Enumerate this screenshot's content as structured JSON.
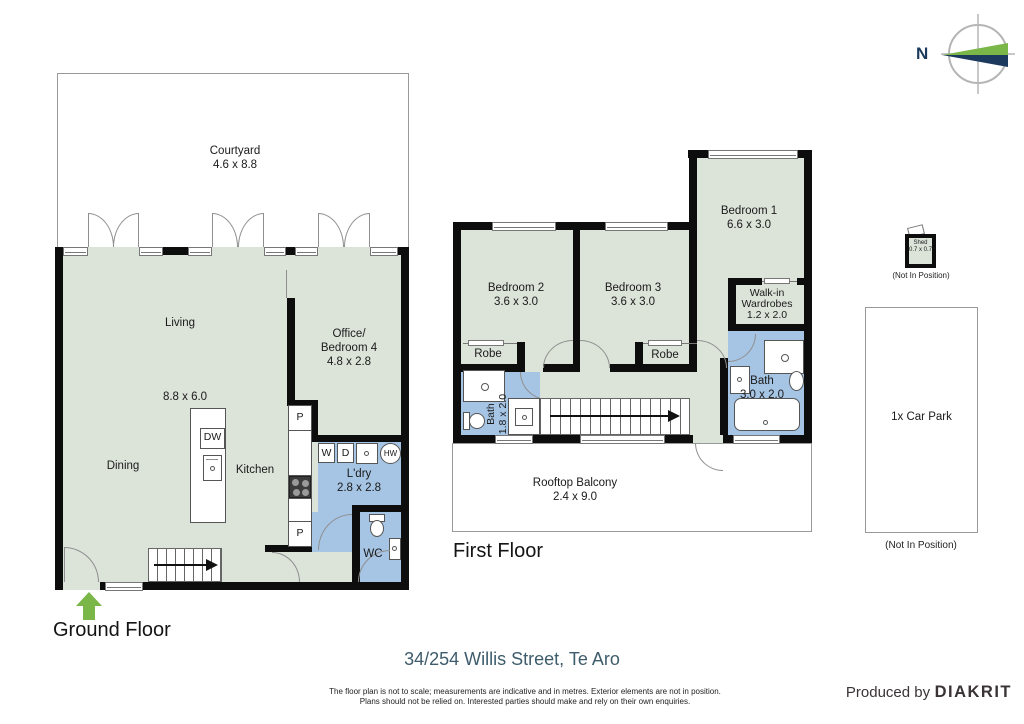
{
  "compass": {
    "north_label": "N"
  },
  "ground_floor": {
    "title": "Ground Floor",
    "courtyard": {
      "name": "Courtyard",
      "dims": "4.6 x 8.8"
    },
    "living": {
      "name": "Living",
      "dims": "8.8 x 6.0"
    },
    "office": {
      "line1": "Office/",
      "line2": "Bedroom 4",
      "dims": "4.8 x 2.8"
    },
    "dining": {
      "name": "Dining"
    },
    "kitchen": {
      "name": "Kitchen",
      "dishwasher": "DW",
      "pantry_top": "P",
      "pantry_bottom": "P"
    },
    "laundry": {
      "name": "L'dry",
      "dims": "2.8 x 2.8",
      "washer": "W",
      "dryer": "D",
      "hot_water": "HW"
    },
    "wc": {
      "name": "WC"
    }
  },
  "first_floor": {
    "title": "First Floor",
    "bedroom1": {
      "name": "Bedroom 1",
      "dims": "6.6 x 3.0"
    },
    "bedroom2": {
      "name": "Bedroom 2",
      "dims": "3.6 x 3.0"
    },
    "bedroom3": {
      "name": "Bedroom 3",
      "dims": "3.6 x 3.0"
    },
    "walkin": {
      "line1": "Walk-in",
      "line2": "Wardrobes",
      "dims": "1.2 x 2.0"
    },
    "robe_left": {
      "name": "Robe"
    },
    "robe_right": {
      "name": "Robe"
    },
    "bath_small": {
      "name": "Bath",
      "dims": "1.8 x 2.0"
    },
    "bath_main": {
      "name": "Bath",
      "dims": "3.0 x 2.0"
    },
    "balcony": {
      "name": "Rooftop Balcony",
      "dims": "2.4 x 9.0"
    }
  },
  "exterior": {
    "shed": {
      "name": "Shed",
      "dims": "0.7 x 0.7",
      "note": "(Not In Position)"
    },
    "carpark": {
      "name": "1x Car Park",
      "note": "(Not In Position)"
    }
  },
  "footer": {
    "address": "34/254 Willis Street, Te Aro",
    "disclaimer1": "The floor plan is not to scale; measurements are indicative and in metres. Exterior elements are not in position.",
    "disclaimer2": "Plans should not be relied on. Interested parties should make and rely on their own enquiries.",
    "produced_by": "Produced by",
    "brand": "DIAKRIT"
  },
  "colors": {
    "room_green": "#dce4da",
    "wet_blue": "#a6c4e4",
    "wall": "#0d0d0d",
    "accent_green": "#7ab648",
    "compass_navy": "#1b3a5e",
    "address_text": "#3e5c6c"
  }
}
